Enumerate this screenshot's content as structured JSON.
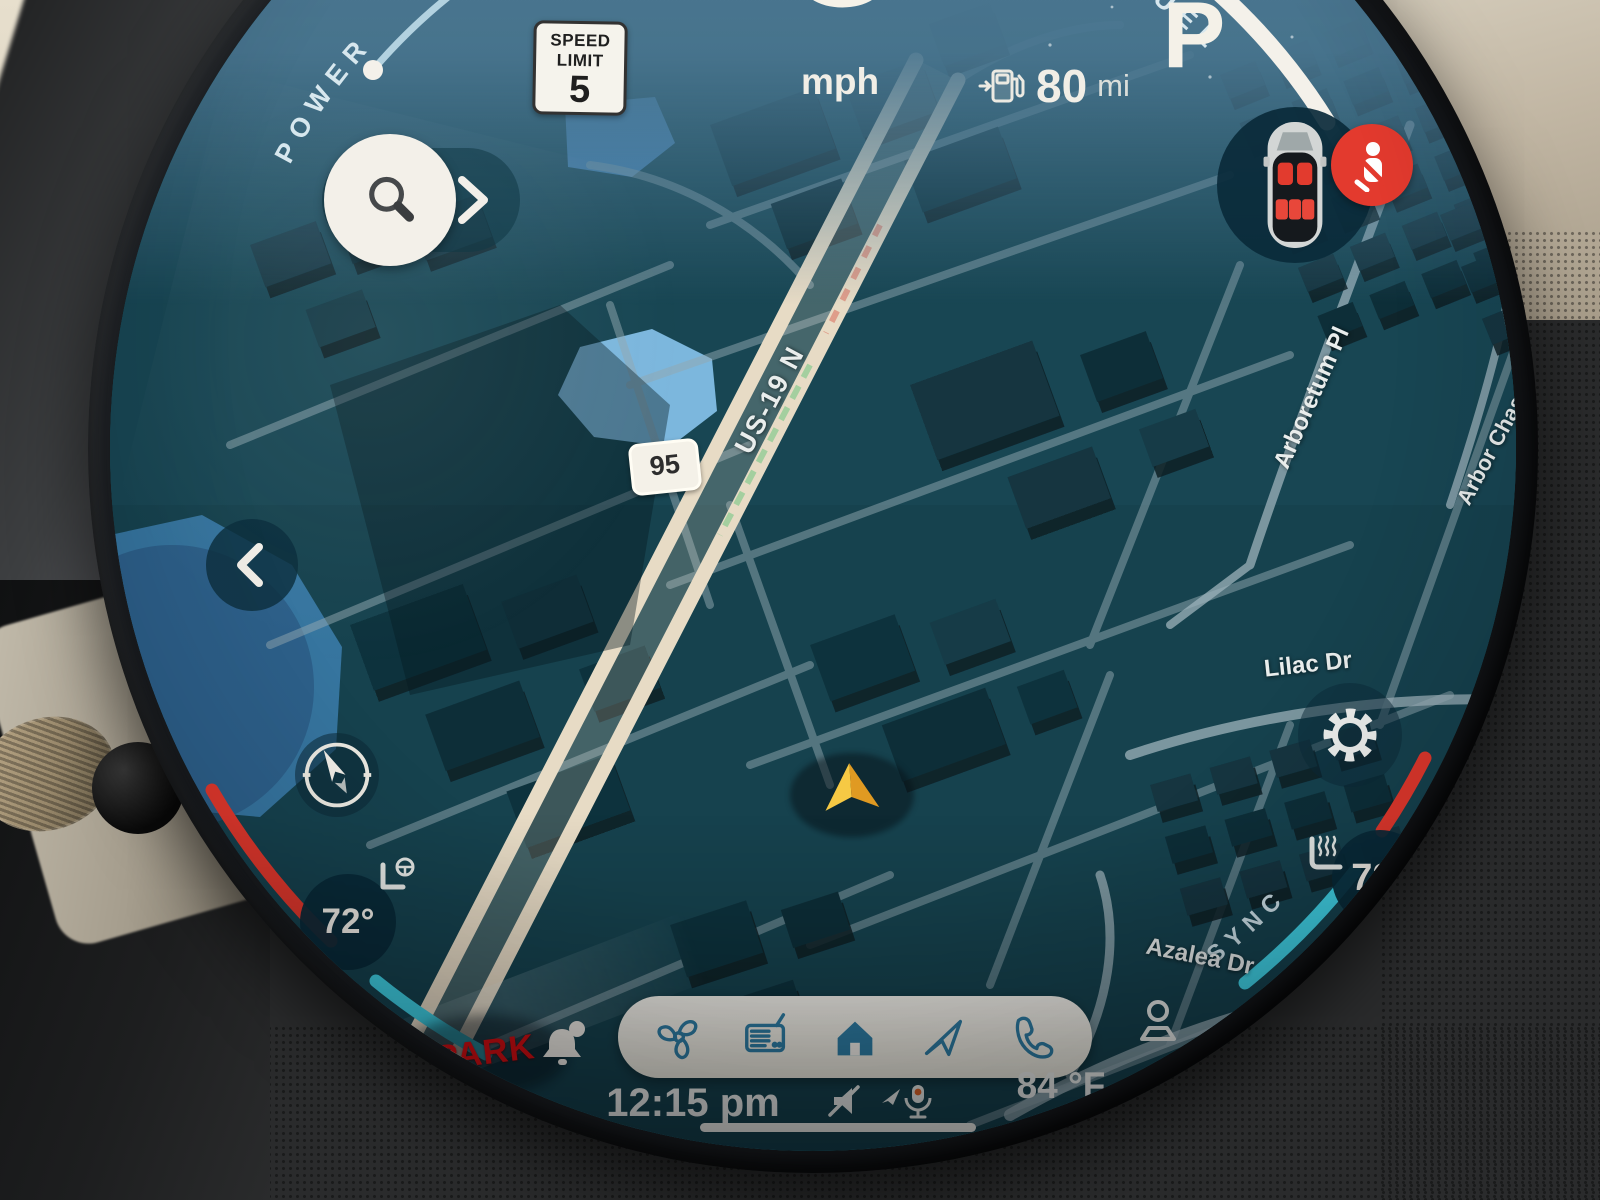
{
  "display": {
    "speed_value": "0",
    "speed_unit": "mph",
    "gear": "P",
    "range_value": "80",
    "range_unit": "mi",
    "power_label": "POWER",
    "fuel_label": "FUEL",
    "limit_line1": "SPEED",
    "limit_line2": "LIMIT",
    "limit_value": "5"
  },
  "map": {
    "highway": "US-19 N",
    "shield": "95",
    "streets": {
      "arboretum": "Arboretum Pl",
      "arbor_chase": "Arbor Chase",
      "lilac": "Lilac Dr",
      "azalea": "Azalea Dr"
    }
  },
  "climate": {
    "left_temp": "72°",
    "right_temp": "72°",
    "sync": "SYNC"
  },
  "footer": {
    "park": "PARK",
    "time": "12:15 pm",
    "outside_temp": "84 °F"
  },
  "colors": {
    "accent_red": "#e2382c",
    "accent_cyan": "#41d4e8",
    "map_base": "#16424e",
    "highway": "#e7dbc5",
    "dock_icon": "#2f7fa6",
    "seat_red": "#e23b2e"
  }
}
